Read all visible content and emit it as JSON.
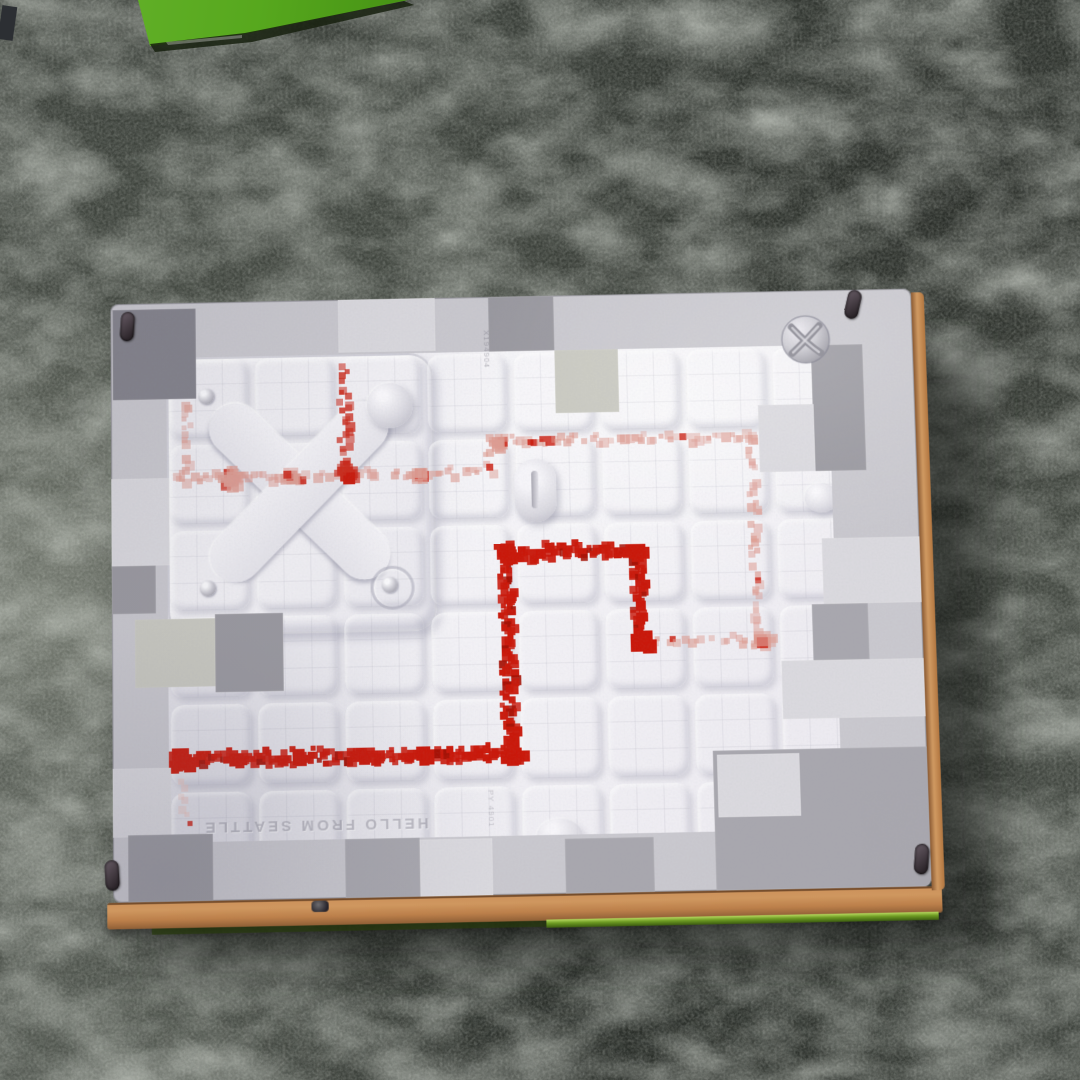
{
  "scene": {
    "description": "photo of Minecraft-themed Xbox console bottom panel lying on a dark shaggy carpet",
    "carpet_base_color": "#4a4f48",
    "green_box_color": "#57a81e"
  },
  "console": {
    "panel_base_color": "#c9c8ce",
    "quartz_color": "#f0eff4",
    "copper_edge_color": "#c08a57",
    "logo_name": "xbox-sphere-logo",
    "embossed_text": "HELLO FROM SEATTLE",
    "mold_mark_top": "X194904",
    "mold_mark_bottom": "PY 4901",
    "shades": {
      "L1": "#dad9de",
      "L2": "#cbcad0",
      "M1": "#a8a7ae",
      "M2": "#99989f",
      "D1": "#82818a",
      "G1": "#c9c9c1"
    },
    "border_blocks": [
      [
        2,
        6,
        84,
        92,
        "D1"
      ],
      [
        230,
        0,
        98,
        54,
        "L1"
      ],
      [
        382,
        0,
        66,
        56,
        "M2"
      ],
      [
        448,
        56,
        64,
        64,
        "G1"
      ],
      [
        707,
        56,
        52,
        128,
        "M2"
      ],
      [
        652,
        116,
        56,
        68,
        "L1"
      ],
      [
        712,
        252,
        98,
        66,
        "L1"
      ],
      [
        700,
        318,
        56,
        56,
        "M1"
      ],
      [
        668,
        374,
        142,
        58,
        "L1"
      ],
      [
        597,
        462,
        215,
        138,
        "M1"
      ],
      [
        601,
        466,
        82,
        62,
        "L1"
      ],
      [
        0,
        178,
        58,
        88,
        "L1"
      ],
      [
        0,
        266,
        44,
        48,
        "M2"
      ],
      [
        23,
        320,
        80,
        68,
        "G1"
      ],
      [
        103,
        316,
        68,
        78,
        "M2"
      ],
      [
        0,
        468,
        58,
        68,
        "L1"
      ],
      [
        15,
        534,
        84,
        66,
        "M2"
      ],
      [
        230,
        542,
        74,
        58,
        "M1"
      ],
      [
        304,
        544,
        72,
        56,
        "L1"
      ],
      [
        448,
        546,
        88,
        54,
        "M1"
      ]
    ],
    "tiles": {
      "cols": 8,
      "rows": 6,
      "size": 80,
      "gap": 7,
      "origin_x": 2,
      "origin_y": 2
    }
  },
  "redstone": {
    "unit": 7,
    "colors": {
      "bright": "#c9180a",
      "medium": "#cc2b1c",
      "faded": "#dd9c92",
      "pale": "#eabcb4"
    },
    "segments": [
      {
        "style": "faded",
        "pts": [
          [
            16,
            44
          ],
          [
            16,
            119
          ]
        ]
      },
      {
        "style": "faded",
        "pts": [
          [
            6,
            119
          ],
          [
            324,
            119
          ]
        ]
      },
      {
        "style": "medium",
        "pts": [
          [
            176,
            6
          ],
          [
            176,
            119
          ]
        ]
      },
      {
        "style": "faded",
        "pts": [
          [
            321,
            86
          ],
          [
            321,
            117
          ]
        ]
      },
      {
        "style": "faded",
        "pts": [
          [
            321,
            88
          ],
          [
            586,
            88
          ]
        ]
      },
      {
        "style": "faded",
        "pts": [
          [
            586,
            90
          ],
          [
            586,
            299
          ]
        ]
      },
      {
        "style": "bright",
        "pts": [
          [
            351,
            200
          ],
          [
            457,
            200
          ]
        ]
      },
      {
        "style": "bright",
        "pts": [
          [
            467,
            206
          ],
          [
            467,
            283
          ]
        ]
      },
      {
        "style": "faded",
        "pts": [
          [
            482,
            293
          ],
          [
            600,
            293
          ]
        ]
      },
      {
        "style": "bright",
        "pts": [
          [
            336,
            216
          ],
          [
            336,
            398
          ]
        ]
      },
      {
        "style": "bright",
        "pts": [
          [
            4,
            400
          ],
          [
            334,
            401
          ]
        ]
      },
      {
        "style": "pale",
        "pts": [
          [
            10,
            418
          ],
          [
            14,
            466
          ]
        ]
      }
    ],
    "clusters": [
      {
        "style": "faded",
        "x": 60,
        "y": 120,
        "r": 15
      },
      {
        "style": "faded",
        "x": 120,
        "y": 118,
        "r": 8
      },
      {
        "style": "medium",
        "x": 176,
        "y": 117,
        "r": 13
      },
      {
        "style": "faded",
        "x": 250,
        "y": 119,
        "r": 8
      },
      {
        "style": "faded",
        "x": 330,
        "y": 88,
        "r": 9
      },
      {
        "style": "bright",
        "x": 337,
        "y": 201,
        "r": 15
      },
      {
        "style": "bright",
        "x": 464,
        "y": 201,
        "r": 12
      },
      {
        "style": "bright",
        "x": 468,
        "y": 291,
        "r": 14
      },
      {
        "style": "bright",
        "x": 337,
        "y": 402,
        "r": 14
      },
      {
        "style": "bright",
        "x": 8,
        "y": 401,
        "r": 17
      },
      {
        "style": "bright",
        "x": 62,
        "y": 400,
        "r": 7
      },
      {
        "style": "bright",
        "x": 124,
        "y": 401,
        "r": 7
      },
      {
        "style": "bright",
        "x": 188,
        "y": 400,
        "r": 8
      },
      {
        "style": "bright",
        "x": 250,
        "y": 401,
        "r": 7
      },
      {
        "style": "faded",
        "x": 588,
        "y": 293,
        "r": 9
      }
    ]
  }
}
